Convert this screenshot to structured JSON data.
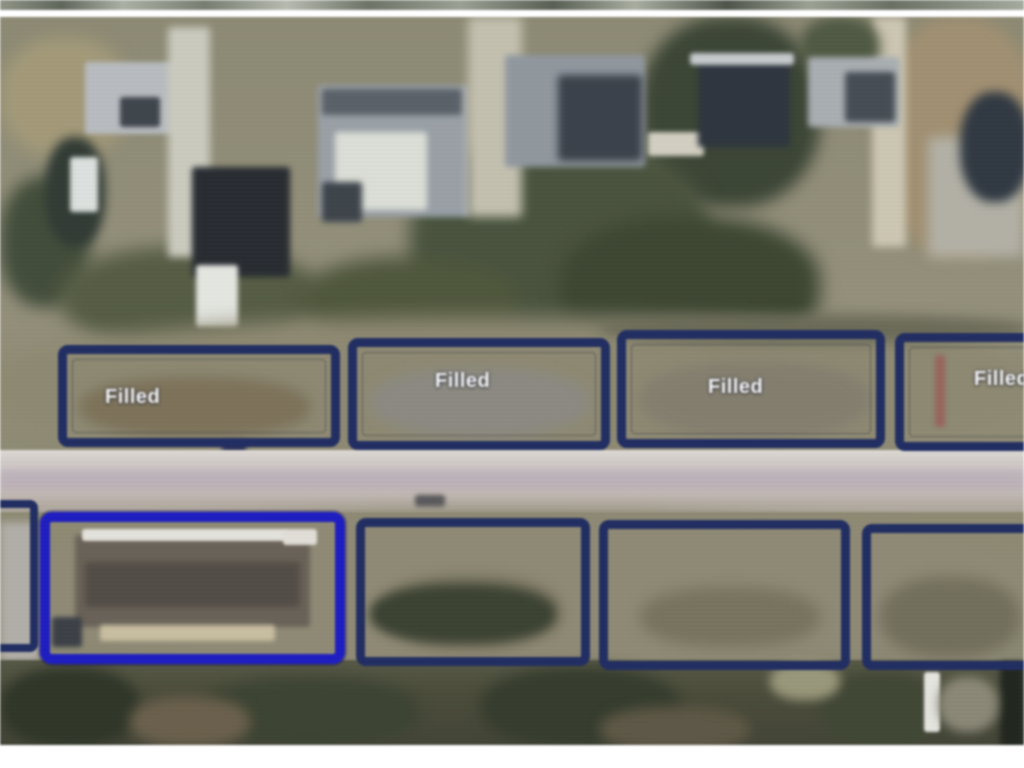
{
  "map": {
    "colors": {
      "parcel_outline": "#1e2c66",
      "parcel_highlight": "#1b1bd0",
      "label_text": "#ffffff"
    },
    "parcels_top": [
      {
        "label": "Filled",
        "partial": false
      },
      {
        "label": "Filled",
        "partial": false
      },
      {
        "label": "Filled",
        "partial": false
      },
      {
        "label": "Filled",
        "partial": true
      }
    ],
    "parcels_bottom": [
      {
        "label": "",
        "highlighted": false,
        "partial": true
      },
      {
        "label": "",
        "highlighted": true,
        "partial": false
      },
      {
        "label": "",
        "highlighted": false,
        "partial": false
      },
      {
        "label": "",
        "highlighted": false,
        "partial": false
      },
      {
        "label": "",
        "highlighted": false,
        "partial": true
      }
    ]
  }
}
